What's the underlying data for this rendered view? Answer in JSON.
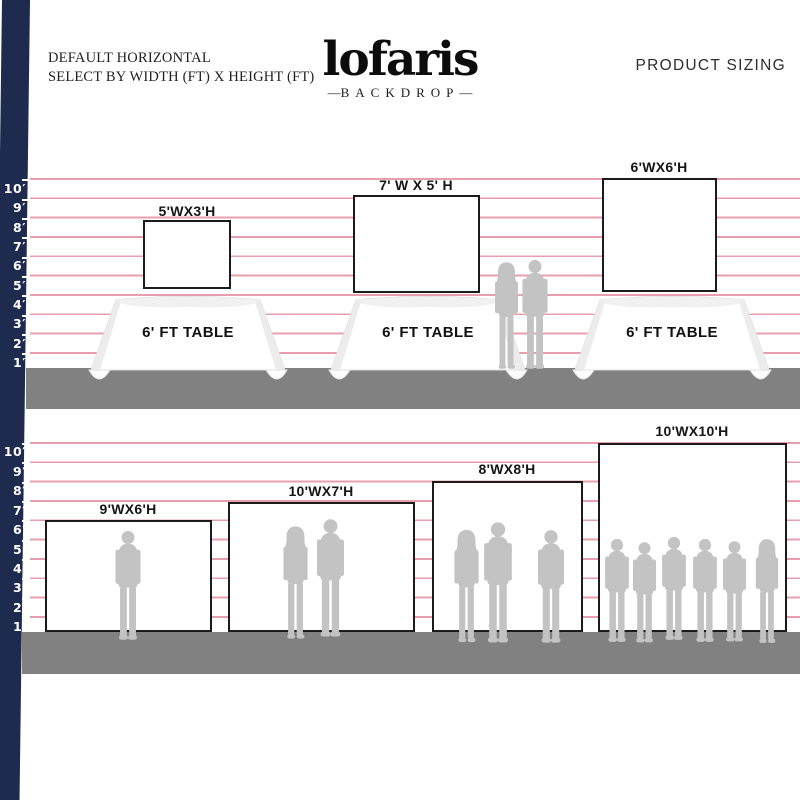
{
  "header": {
    "mode_line1": "DEFAULT HORIZONTAL",
    "mode_line2": "SELECT BY WIDTH (FT) X HEIGHT (FT)",
    "logo_text": "lofaris",
    "logo_subtext": "BACKDROP",
    "right_title": "PRODUCT SIZING"
  },
  "ruler": {
    "unit": "ft",
    "labels": [
      "10′",
      "9′",
      "8′",
      "7′",
      "6′",
      "5′",
      "4′",
      "3′",
      "2′",
      "1′"
    ]
  },
  "top_section": {
    "table_label": "6' FT TABLE",
    "backdrops": [
      {
        "label": "5'WX3'H",
        "width_ft": 5,
        "height_ft": 3,
        "people": 0
      },
      {
        "label": "7' W X 5' H",
        "width_ft": 7,
        "height_ft": 5,
        "people": 0
      },
      {
        "label": "6'WX6'H",
        "width_ft": 6,
        "height_ft": 6,
        "people": 0
      }
    ],
    "standing_couple_people": 2
  },
  "bottom_section": {
    "backdrops": [
      {
        "label": "9'WX6'H",
        "width_ft": 9,
        "height_ft": 6,
        "people": 1
      },
      {
        "label": "10'WX7'H",
        "width_ft": 10,
        "height_ft": 7,
        "people": 2
      },
      {
        "label": "8'WX8'H",
        "width_ft": 8,
        "height_ft": 8,
        "people": 3
      },
      {
        "label": "10'WX10'H",
        "width_ft": 10,
        "height_ft": 10,
        "people": 6
      }
    ]
  },
  "colors": {
    "navy_bar": "#1e2b4f",
    "grid_pink": "#e79fad",
    "floor_gray": "#818181",
    "silhouette_gray": "#c3c3c3",
    "ink": "#151515"
  }
}
